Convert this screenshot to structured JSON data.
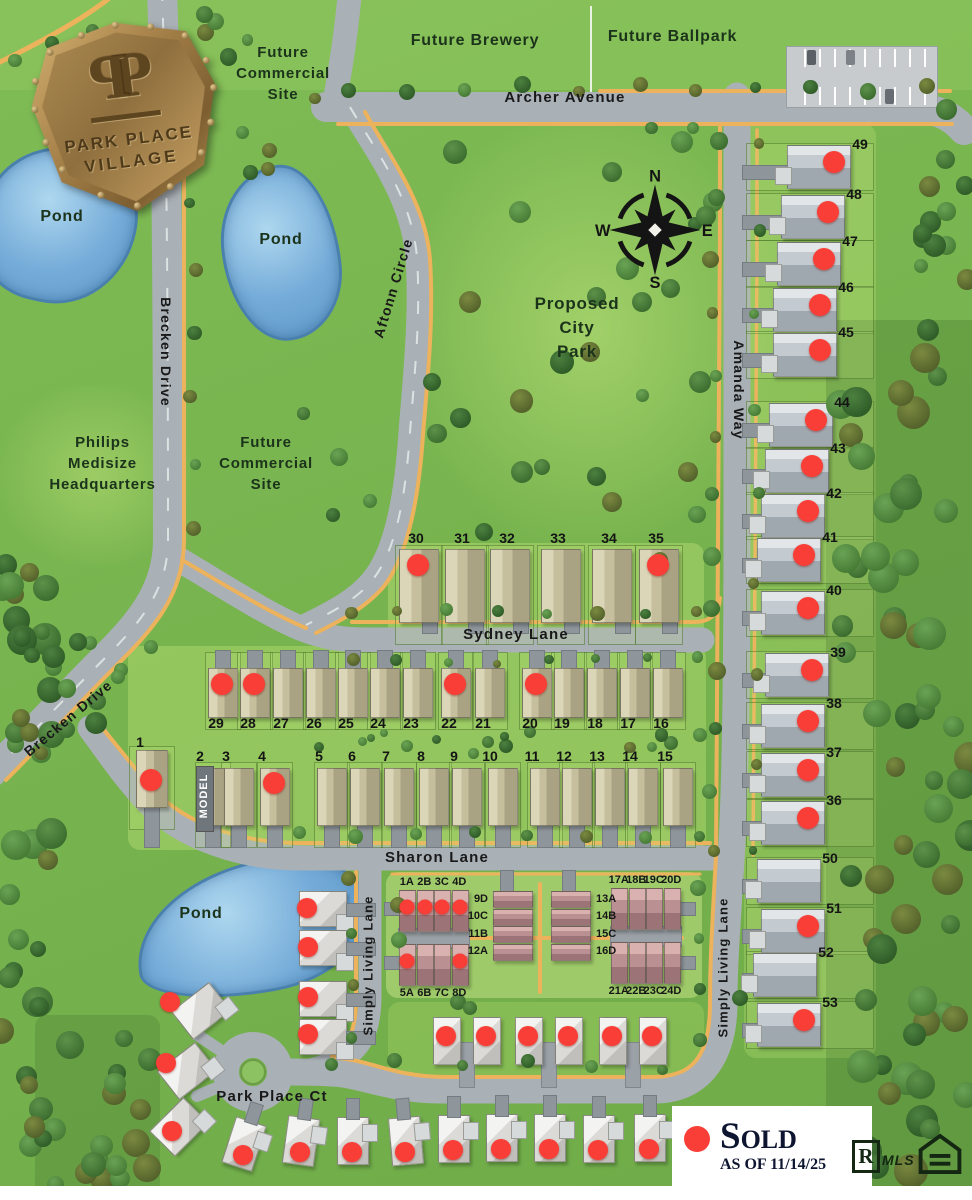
{
  "logo": {
    "monogram_left": "P",
    "monogram_right": "P",
    "name_line1": "PARK PLACE",
    "name_line2": "VILLAGE"
  },
  "legend": {
    "sold_label": "Sold",
    "as_of": "AS OF 11/14/25",
    "sold_color": "#f83e36",
    "realtor_letter": "R",
    "mls_label": "MLS"
  },
  "compass": {
    "n": "N",
    "e": "E",
    "s": "S",
    "w": "W"
  },
  "areas": {
    "future_commercial": "Future\nCommercial\nSite",
    "future_brewery": "Future Brewery",
    "future_ballpark": "Future Ballpark",
    "proposed_city_park": "Proposed\nCity\nPark",
    "philips": "Philips\nMedisize\nHeadquarters",
    "pond": "Pond",
    "model": "MODEL"
  },
  "streets": {
    "archer": "Archer Avenue",
    "brecken": "Brecken Drive",
    "aftonn": "Aftonn Circle",
    "amanda": "Amanda Way",
    "sydney": "Sydney Lane",
    "sharon": "Sharon Lane",
    "simply_living": "Simply Living Lane",
    "park_place_ct": "Park Place Ct"
  },
  "lots": {
    "amanda_way_column": [
      {
        "n": "49",
        "x": 818,
        "y": 166,
        "sold": true
      },
      {
        "n": "48",
        "x": 812,
        "y": 216,
        "sold": true
      },
      {
        "n": "47",
        "x": 808,
        "y": 263,
        "sold": true
      },
      {
        "n": "46",
        "x": 804,
        "y": 309,
        "sold": true
      },
      {
        "n": "45",
        "x": 804,
        "y": 354,
        "sold": true
      },
      {
        "n": "44",
        "x": 800,
        "y": 424,
        "sold": true
      },
      {
        "n": "43",
        "x": 796,
        "y": 470,
        "sold": true
      },
      {
        "n": "42",
        "x": 792,
        "y": 515,
        "sold": true
      },
      {
        "n": "41",
        "x": 788,
        "y": 559,
        "sold": true
      },
      {
        "n": "40",
        "x": 792,
        "y": 612,
        "sold": true
      },
      {
        "n": "39",
        "x": 796,
        "y": 674,
        "sold": true
      },
      {
        "n": "38",
        "x": 792,
        "y": 725,
        "sold": true
      },
      {
        "n": "37",
        "x": 792,
        "y": 774,
        "sold": true
      },
      {
        "n": "36",
        "x": 792,
        "y": 822,
        "sold": true
      },
      {
        "n": "50",
        "x": 788,
        "y": 880,
        "sold": false
      },
      {
        "n": "51",
        "x": 792,
        "y": 930,
        "sold": true
      },
      {
        "n": "52",
        "x": 784,
        "y": 974,
        "sold": false
      },
      {
        "n": "53",
        "x": 788,
        "y": 1024,
        "sold": true
      }
    ],
    "sydney_north_row": [
      {
        "n": "30",
        "x": 418,
        "y": 585,
        "sold": true
      },
      {
        "n": "31",
        "x": 464,
        "y": 585,
        "sold": false
      },
      {
        "n": "32",
        "x": 509,
        "y": 585,
        "sold": false
      },
      {
        "n": "33",
        "x": 560,
        "y": 587,
        "sold": false
      },
      {
        "n": "34",
        "x": 611,
        "y": 587,
        "sold": false
      },
      {
        "n": "35",
        "x": 658,
        "y": 587,
        "sold": true
      }
    ],
    "sydney_south_row": [
      {
        "n": "29",
        "x": 222,
        "y": 692,
        "sold": true
      },
      {
        "n": "28",
        "x": 254,
        "y": 692,
        "sold": true
      },
      {
        "n": "27",
        "x": 287,
        "y": 694,
        "sold": false
      },
      {
        "n": "26",
        "x": 320,
        "y": 696,
        "sold": false
      },
      {
        "n": "25",
        "x": 352,
        "y": 698,
        "sold": false
      },
      {
        "n": "24",
        "x": 384,
        "y": 698,
        "sold": false
      },
      {
        "n": "23",
        "x": 417,
        "y": 698,
        "sold": false
      },
      {
        "n": "22",
        "x": 455,
        "y": 700,
        "sold": true
      },
      {
        "n": "21",
        "x": 489,
        "y": 700,
        "sold": false
      },
      {
        "n": "20",
        "x": 536,
        "y": 700,
        "sold": true
      },
      {
        "n": "19",
        "x": 568,
        "y": 700,
        "sold": false
      },
      {
        "n": "18",
        "x": 601,
        "y": 700,
        "sold": false
      },
      {
        "n": "17",
        "x": 634,
        "y": 698,
        "sold": false
      },
      {
        "n": "16",
        "x": 667,
        "y": 698,
        "sold": false
      }
    ],
    "sharon_north_row": [
      {
        "n": "1",
        "x": 151,
        "y": 780,
        "sold": true
      },
      {
        "n": "2",
        "x": 212,
        "y": 797,
        "sold": false,
        "model": true
      },
      {
        "n": "3",
        "x": 238,
        "y": 797,
        "sold": false
      },
      {
        "n": "4",
        "x": 274,
        "y": 797,
        "sold": true
      },
      {
        "n": "5",
        "x": 331,
        "y": 799,
        "sold": false
      },
      {
        "n": "6",
        "x": 364,
        "y": 799,
        "sold": false
      },
      {
        "n": "7",
        "x": 398,
        "y": 801,
        "sold": false
      },
      {
        "n": "8",
        "x": 433,
        "y": 801,
        "sold": false
      },
      {
        "n": "9",
        "x": 466,
        "y": 801,
        "sold": false
      },
      {
        "n": "10",
        "x": 502,
        "y": 801,
        "sold": false
      },
      {
        "n": "11",
        "x": 544,
        "y": 799,
        "sold": false
      },
      {
        "n": "12",
        "x": 576,
        "y": 799,
        "sold": false
      },
      {
        "n": "13",
        "x": 609,
        "y": 799,
        "sold": false
      },
      {
        "n": "14",
        "x": 642,
        "y": 797,
        "sold": false
      },
      {
        "n": "15",
        "x": 677,
        "y": 797,
        "sold": false
      }
    ]
  },
  "condos": {
    "quads": [
      {
        "x": 398,
        "y": 890,
        "side": "top",
        "units": [
          {
            "l": "1A",
            "sold": true
          },
          {
            "l": "2B",
            "sold": true
          },
          {
            "l": "3C",
            "sold": true
          },
          {
            "l": "4D",
            "sold": true
          }
        ]
      },
      {
        "x": 398,
        "y": 944,
        "side": "bottom",
        "units": [
          {
            "l": "5A",
            "sold": true
          },
          {
            "l": "6B",
            "sold": false
          },
          {
            "l": "7C",
            "sold": false
          },
          {
            "l": "8D",
            "sold": true
          }
        ]
      },
      {
        "x": 610,
        "y": 888,
        "side": "top",
        "units": [
          {
            "l": "17A",
            "sold": false
          },
          {
            "l": "18B",
            "sold": false
          },
          {
            "l": "19C",
            "sold": false
          },
          {
            "l": "20D",
            "sold": false
          }
        ]
      },
      {
        "x": 610,
        "y": 942,
        "side": "bottom",
        "units": [
          {
            "l": "21A",
            "sold": false
          },
          {
            "l": "22B",
            "sold": false
          },
          {
            "l": "23C",
            "sold": false
          },
          {
            "l": "24D",
            "sold": false
          }
        ]
      }
    ],
    "stacks": [
      {
        "x": 492,
        "y": 890,
        "side": "left",
        "units": [
          {
            "l": "9D",
            "sold": false
          },
          {
            "l": "10C",
            "sold": false
          },
          {
            "l": "11B",
            "sold": false
          },
          {
            "l": "12A",
            "sold": false
          }
        ]
      },
      {
        "x": 550,
        "y": 890,
        "side": "right",
        "units": [
          {
            "l": "13A",
            "sold": false
          },
          {
            "l": "14B",
            "sold": false
          },
          {
            "l": "15C",
            "sold": false
          },
          {
            "l": "16D",
            "sold": false
          }
        ]
      }
    ]
  },
  "villas": [
    {
      "x": 466,
      "y": 1040,
      "sold": [
        true,
        true
      ]
    },
    {
      "x": 548,
      "y": 1040,
      "sold": [
        true,
        true
      ]
    },
    {
      "x": 632,
      "y": 1040,
      "sold": [
        true,
        true
      ]
    }
  ],
  "west_homes": [
    {
      "x": 200,
      "y": 1010,
      "rot": -38,
      "sold": true,
      "dx": -30,
      "dy": -8
    },
    {
      "x": 186,
      "y": 1070,
      "rot": -38,
      "sold": true,
      "dx": -20,
      "dy": -7
    },
    {
      "x": 178,
      "y": 1126,
      "rot": -45,
      "sold": true,
      "dx": -6,
      "dy": 5
    },
    {
      "x": 322,
      "y": 908,
      "rot": 0,
      "sold": true,
      "dx": -15,
      "dy": 0,
      "east_drive": true
    },
    {
      "x": 322,
      "y": 947,
      "rot": 0,
      "sold": true,
      "dx": -14,
      "dy": 0,
      "east_drive": true
    },
    {
      "x": 322,
      "y": 998,
      "rot": 0,
      "sold": true,
      "dx": -14,
      "dy": -1,
      "east_drive": true
    },
    {
      "x": 322,
      "y": 1036,
      "rot": 0,
      "sold": true,
      "dx": -14,
      "dy": -2,
      "east_drive": true
    }
  ],
  "bottom_homes": [
    {
      "x": 243,
      "y": 1143,
      "rot": 18,
      "sold": true
    },
    {
      "x": 300,
      "y": 1140,
      "rot": 8,
      "sold": true
    },
    {
      "x": 352,
      "y": 1140,
      "rot": 0,
      "sold": true
    },
    {
      "x": 405,
      "y": 1140,
      "rot": -5,
      "sold": true
    },
    {
      "x": 453,
      "y": 1138,
      "rot": 0,
      "sold": true
    },
    {
      "x": 501,
      "y": 1137,
      "rot": 0,
      "sold": true
    },
    {
      "x": 549,
      "y": 1137,
      "rot": 0,
      "sold": true
    },
    {
      "x": 598,
      "y": 1138,
      "rot": 0,
      "sold": true
    },
    {
      "x": 649,
      "y": 1137,
      "rot": 0,
      "sold": true
    }
  ]
}
